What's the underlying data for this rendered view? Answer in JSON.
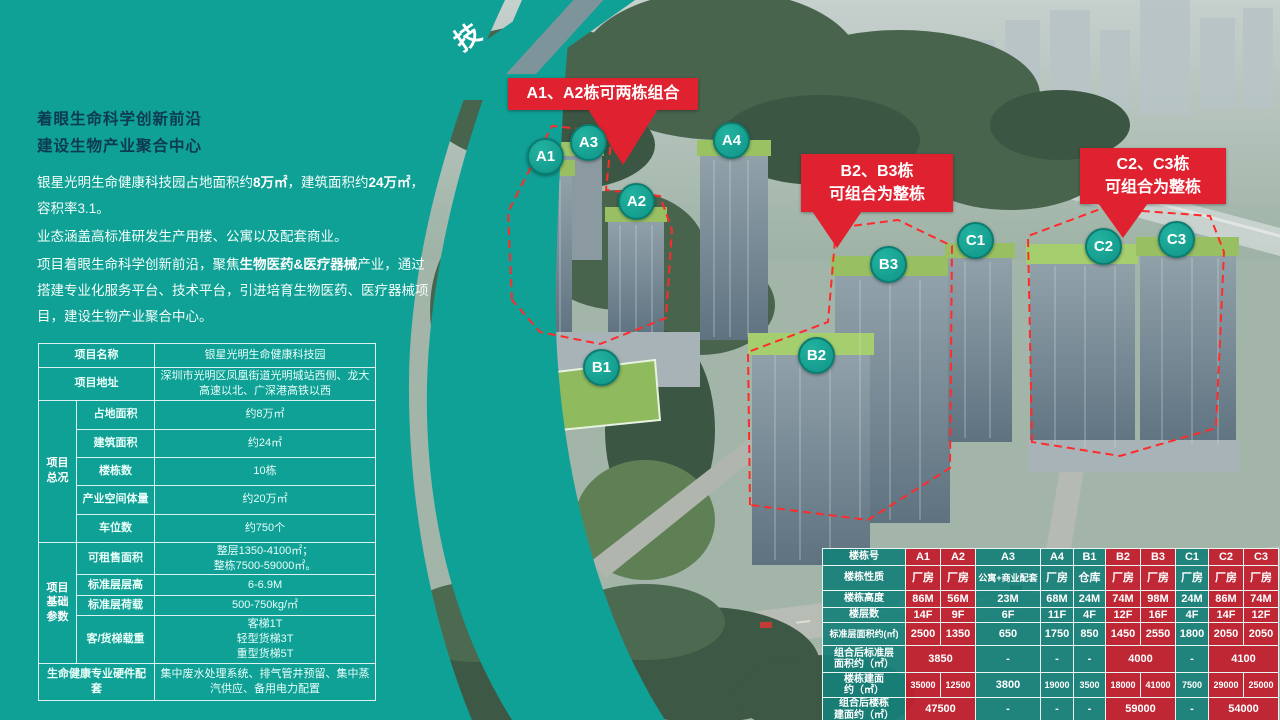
{
  "ribbon": {
    "partial_text": "技"
  },
  "intro": {
    "headline_line1": "着眼生命科学创新前沿",
    "headline_line2": "建设生物产业聚合中心",
    "para1_prefix": "银星光明生命健康科技园占地面积约",
    "para1_bold1": "8万㎡",
    "para1_mid": "，建筑面积约",
    "para1_bold2": "24万㎡",
    "para1_suffix": "，容积率3.1。",
    "para2": "业态涵盖高标准研发生产用楼、公寓以及配套商业。",
    "para3_prefix": "项目着眼生命科学创新前沿，聚焦",
    "para3_bold": "生物医药&医疗器械",
    "para3_suffix": "产业，通过搭建专业化服务平台、技术平台，引进培育生物医药、医疗器械项目，建设生物产业聚合中心。"
  },
  "project_table": {
    "name_label": "项目名称",
    "name_value": "银星光明生命健康科技园",
    "addr_label": "项目地址",
    "addr_value": "深圳市光明区凤凰街道光明城站西侧、龙大高速以北、广深港高铁以西",
    "overview_label": "项目\n总况",
    "overview_rows": [
      [
        "占地面积",
        "约8万㎡"
      ],
      [
        "建筑面积",
        "约24㎡"
      ],
      [
        "楼栋数",
        "10栋"
      ],
      [
        "产业空间体量",
        "约20万㎡"
      ],
      [
        "车位数",
        "约750个"
      ]
    ],
    "params_label": "项目基础参数",
    "params_rows": [
      [
        "可租售面积",
        "整层1350-4100㎡；\n整栋7500-59000㎡。"
      ],
      [
        "标准层层高",
        "6-6.9M"
      ],
      [
        "标准层荷载",
        "500-750kg/㎡"
      ],
      [
        "客/货梯载重",
        "客梯1T\n轻型货梯3T\n重型货梯5T"
      ]
    ],
    "hardware_label": "生命健康专业硬件配套",
    "hardware_value": "集中废水处理系统、排气管井预留、集中蒸汽供应、备用电力配置"
  },
  "callouts": {
    "a": "A1、A2栋可两栋组合",
    "b_line1": "B2、B3栋",
    "b_line2": "可组合为整栋",
    "c_line1": "C2、C3栋",
    "c_line2": "可组合为整栋"
  },
  "badges": [
    {
      "label": "A1"
    },
    {
      "label": "A3"
    },
    {
      "label": "A2"
    },
    {
      "label": "A4"
    },
    {
      "label": "B1"
    },
    {
      "label": "B2"
    },
    {
      "label": "B3"
    },
    {
      "label": "C1"
    },
    {
      "label": "C2"
    },
    {
      "label": "C3"
    }
  ],
  "spec_table": {
    "rows": [
      {
        "label": "楼栋号",
        "cells": [
          "A1",
          "A2",
          "A3",
          "A4",
          "B1",
          "B2",
          "B3",
          "C1",
          "C2",
          "C3"
        ]
      },
      {
        "label": "楼栋性质",
        "cells": [
          "厂房",
          "厂房",
          "公寓+商业配套",
          "厂房",
          "仓库",
          "厂房",
          "厂房",
          "厂房",
          "厂房",
          "厂房"
        ]
      },
      {
        "label": "楼栋高度",
        "cells": [
          "86M",
          "56M",
          "23M",
          "68M",
          "24M",
          "74M",
          "98M",
          "24M",
          "86M",
          "74M"
        ]
      },
      {
        "label": "楼层数",
        "cells": [
          "14F",
          "9F",
          "6F",
          "11F",
          "4F",
          "12F",
          "16F",
          "4F",
          "14F",
          "12F"
        ]
      },
      {
        "label": "标准层面积约(㎡)",
        "cells": [
          "2500",
          "1350",
          "650",
          "1750",
          "850",
          "1450",
          "2550",
          "1800",
          "2050",
          "2050"
        ]
      },
      {
        "label": "组合后标准层\n面积约（㎡）",
        "cells": [
          "3850",
          "-",
          "-",
          "-",
          "4000",
          "-",
          "4100"
        ]
      },
      {
        "label": "楼栋建面\n约（㎡）",
        "cells": [
          "35000",
          "12500",
          "3800",
          "19000",
          "3500",
          "18000",
          "41000",
          "7500",
          "29000",
          "25000"
        ]
      },
      {
        "label": "组合后楼栋\n建面约（㎡）",
        "cells": [
          "47500",
          "-",
          "-",
          "-",
          "59000",
          "-",
          "54000"
        ]
      }
    ]
  },
  "colors": {
    "panel_teal": "#0fa096",
    "table_red": "#c1202e",
    "callout_red": "#e0212f"
  }
}
